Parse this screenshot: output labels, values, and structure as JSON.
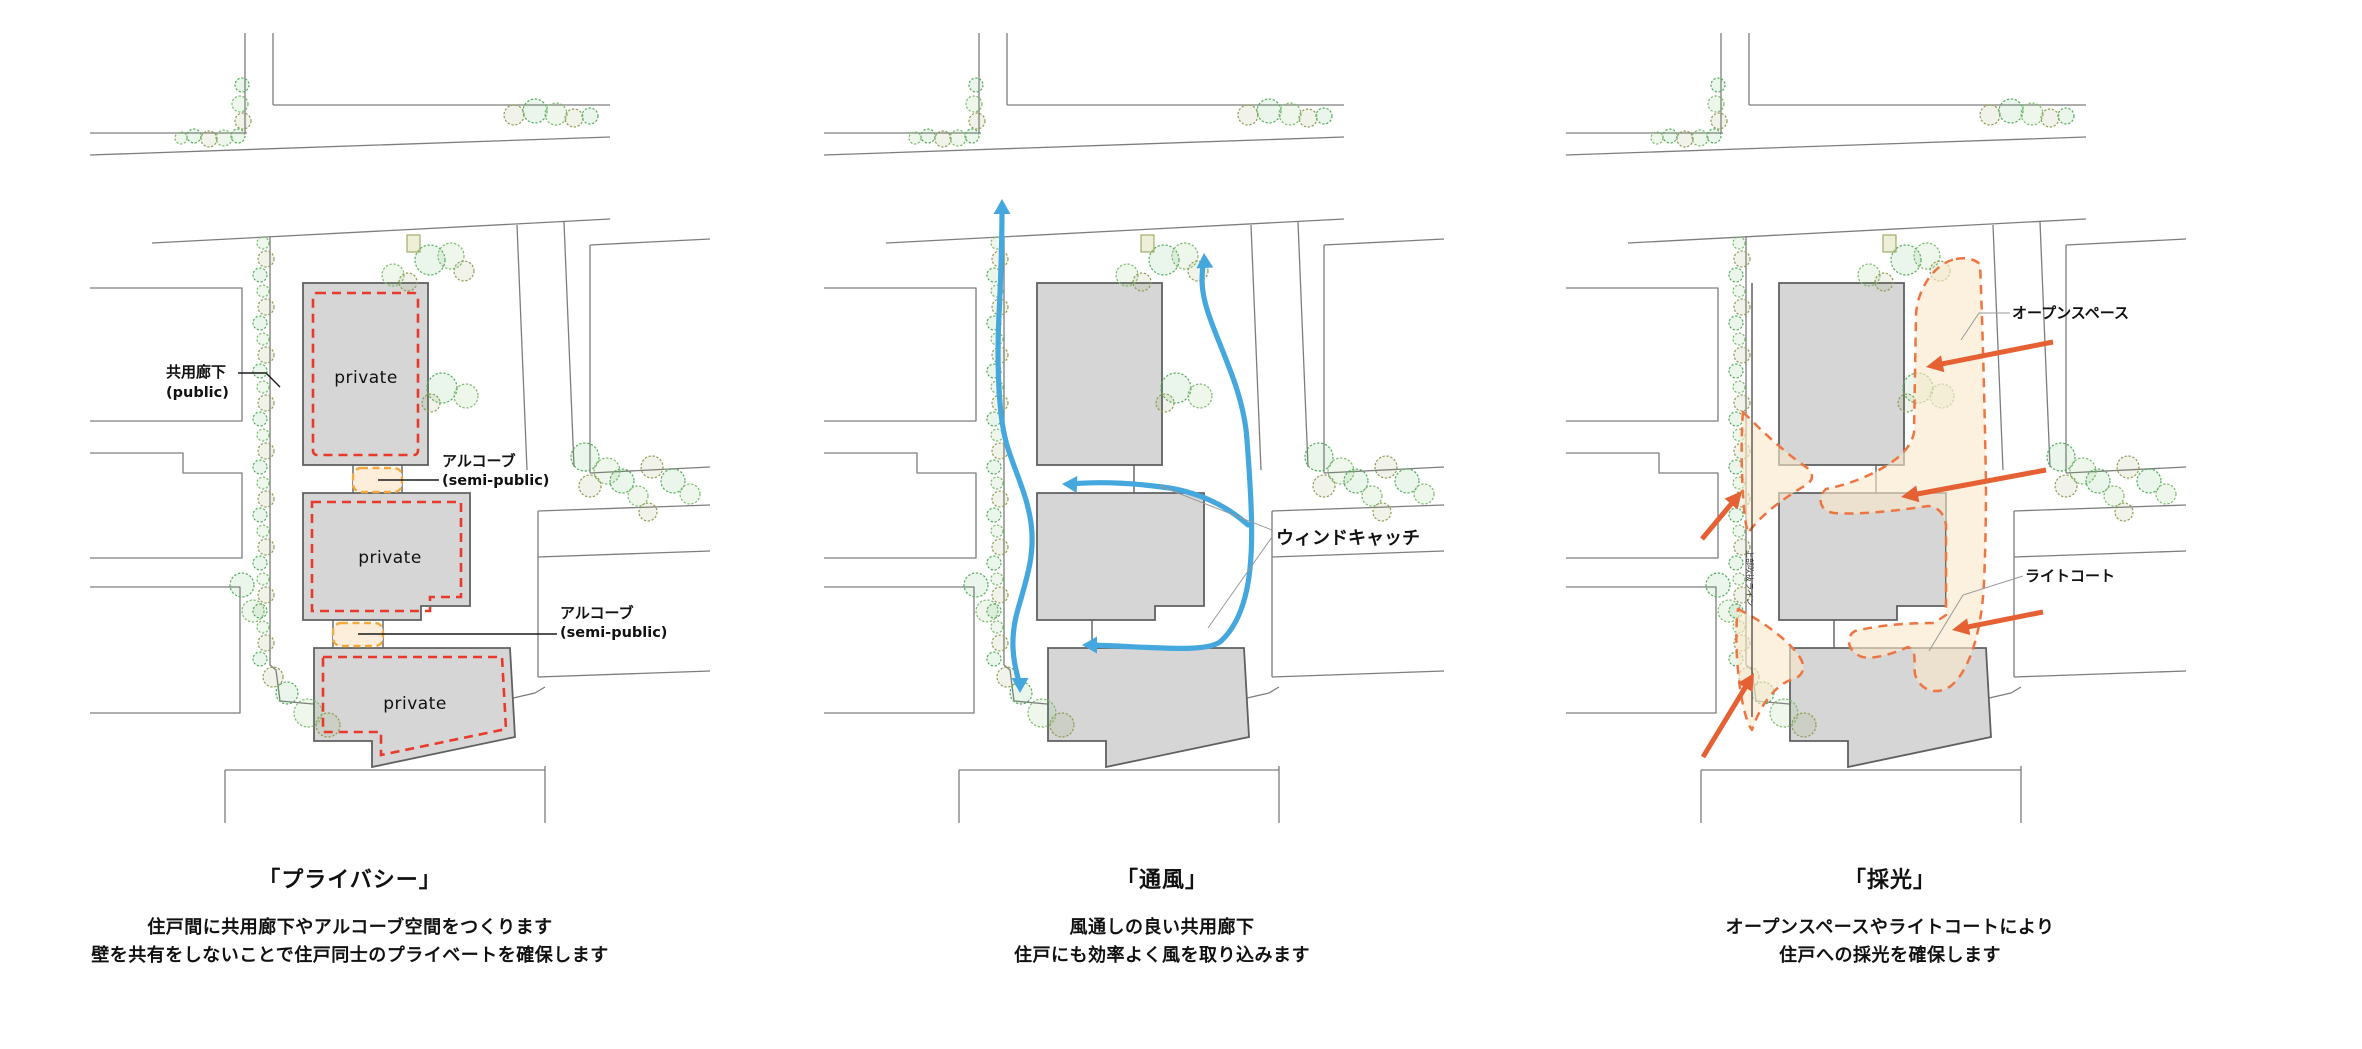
{
  "panels": [
    {
      "id": "privacy",
      "title": "「プライバシー」",
      "caption_lines": [
        "住戸間に共用廊下やアルコーブ空間をつくります",
        "壁を共有をしないことで住戸同士のプライベートを確保します"
      ],
      "labels": {
        "corridor_jp": "共用廊下",
        "corridor_en": "(public)",
        "alcove_jp": "アルコーブ",
        "alcove_en": "(semi-public)",
        "building": "private"
      }
    },
    {
      "id": "ventilation",
      "title": "「通風」",
      "caption_lines": [
        "風通しの良い共用廊下",
        "住戸にも効率よく風を取り込みます"
      ],
      "labels": {
        "windcatch": "ウィンドキャッチ"
      }
    },
    {
      "id": "daylight",
      "title": "「採光」",
      "caption_lines": [
        "オープンスペースやライトコートにより",
        "住戸への採光を確保します"
      ],
      "labels": {
        "openspace": "オープンスペース",
        "lightcourt": "ライトコート",
        "void_line": "上部吹抜ライン"
      }
    }
  ],
  "colors": {
    "site_line": "#7d7d7d",
    "building_fill": "#d5d6d5",
    "building_stroke": "#5f6062",
    "private_dash": "#e8392b",
    "alcove_fill": "#fdeedb",
    "alcove_stroke": "#f2a93e",
    "wind_blue": "#44a7dd",
    "sun_orange": "#e56033",
    "openspace_fill": "#f8e8c9",
    "openspace_dash": "#ee7442",
    "leader_line": "#1a1a1a",
    "thin_leader": "#999999",
    "tree_greens": [
      "#56ab5e",
      "#7cba6d",
      "#8f9c52"
    ]
  }
}
